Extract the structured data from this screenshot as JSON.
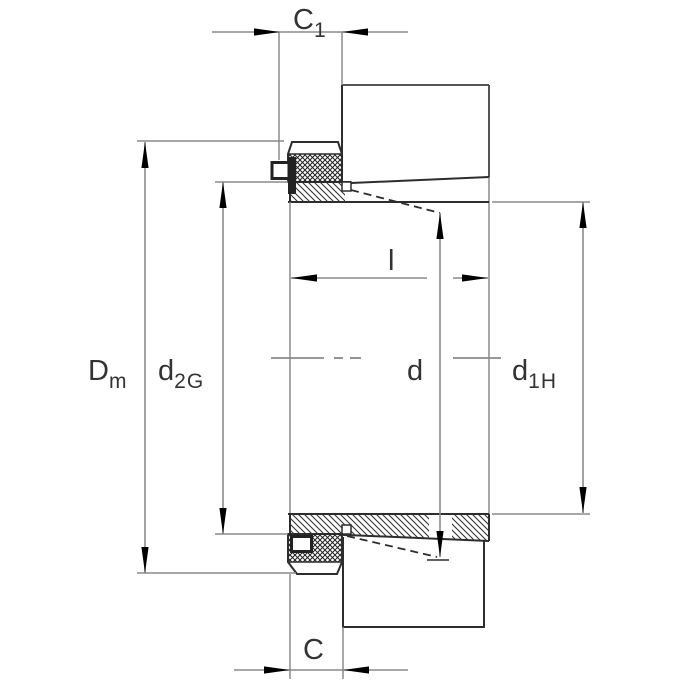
{
  "drawing": {
    "kind": "bearing-adapter-sleeve-cross-section",
    "labels": {
      "c1": {
        "main": "C",
        "sub": "1"
      },
      "dm": {
        "main": "D",
        "sub": "m"
      },
      "d2g": {
        "main": "d",
        "sub": "2G"
      },
      "l": {
        "main": "l",
        "sub": ""
      },
      "d": {
        "main": "d",
        "sub": ""
      },
      "d1h": {
        "main": "d",
        "sub": "1H"
      },
      "c": {
        "main": "C",
        "sub": ""
      }
    },
    "colors": {
      "background": "#ffffff",
      "object_line": "#2d2d2d",
      "dimension_line": "#8a8a8a",
      "arrow": "#000000",
      "label_text": "#333333"
    }
  }
}
